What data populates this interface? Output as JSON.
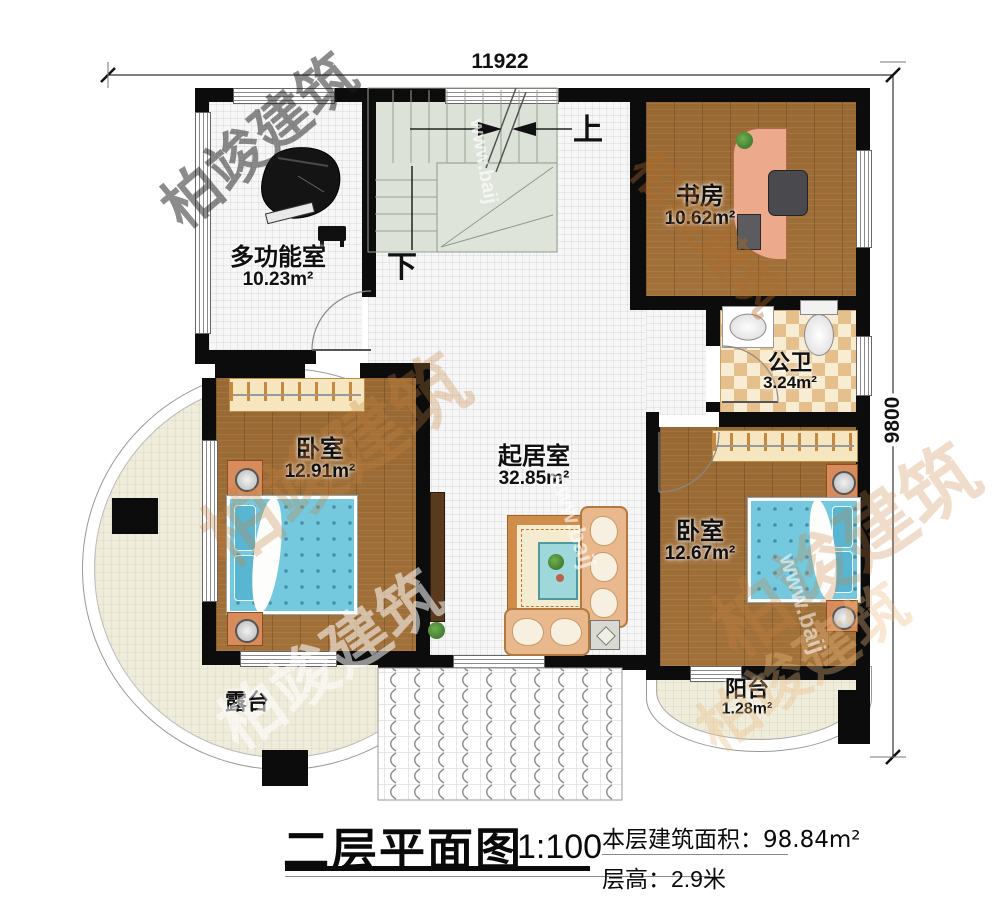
{
  "title_block": {
    "title": "二层平面图",
    "scale": "1:100",
    "area_label": "本层建筑面积：",
    "area_value": "98.84m²",
    "height_label": "层高：",
    "height_value": "2.9米"
  },
  "dimensions": {
    "top": "11922",
    "right": "9800"
  },
  "stairs": {
    "up_label": "上",
    "down_label": "下"
  },
  "rooms": {
    "multi": {
      "name": "多功能室",
      "area": "10.23m²"
    },
    "study": {
      "name": "书房",
      "area": "10.62m²"
    },
    "bath": {
      "name": "公卫",
      "area": "3.24m²"
    },
    "bedroom_left": {
      "name": "卧室",
      "area": "12.91m²"
    },
    "living": {
      "name": "起居室",
      "area": "32.85m²"
    },
    "bedroom_right": {
      "name": "卧室",
      "area": "12.67m²"
    },
    "terrace": {
      "name": "露台"
    },
    "balcony": {
      "name": "阳台",
      "area": "1.28m²"
    }
  },
  "watermark": {
    "brand": "柏竣建筑",
    "site": "www.baij"
  }
}
